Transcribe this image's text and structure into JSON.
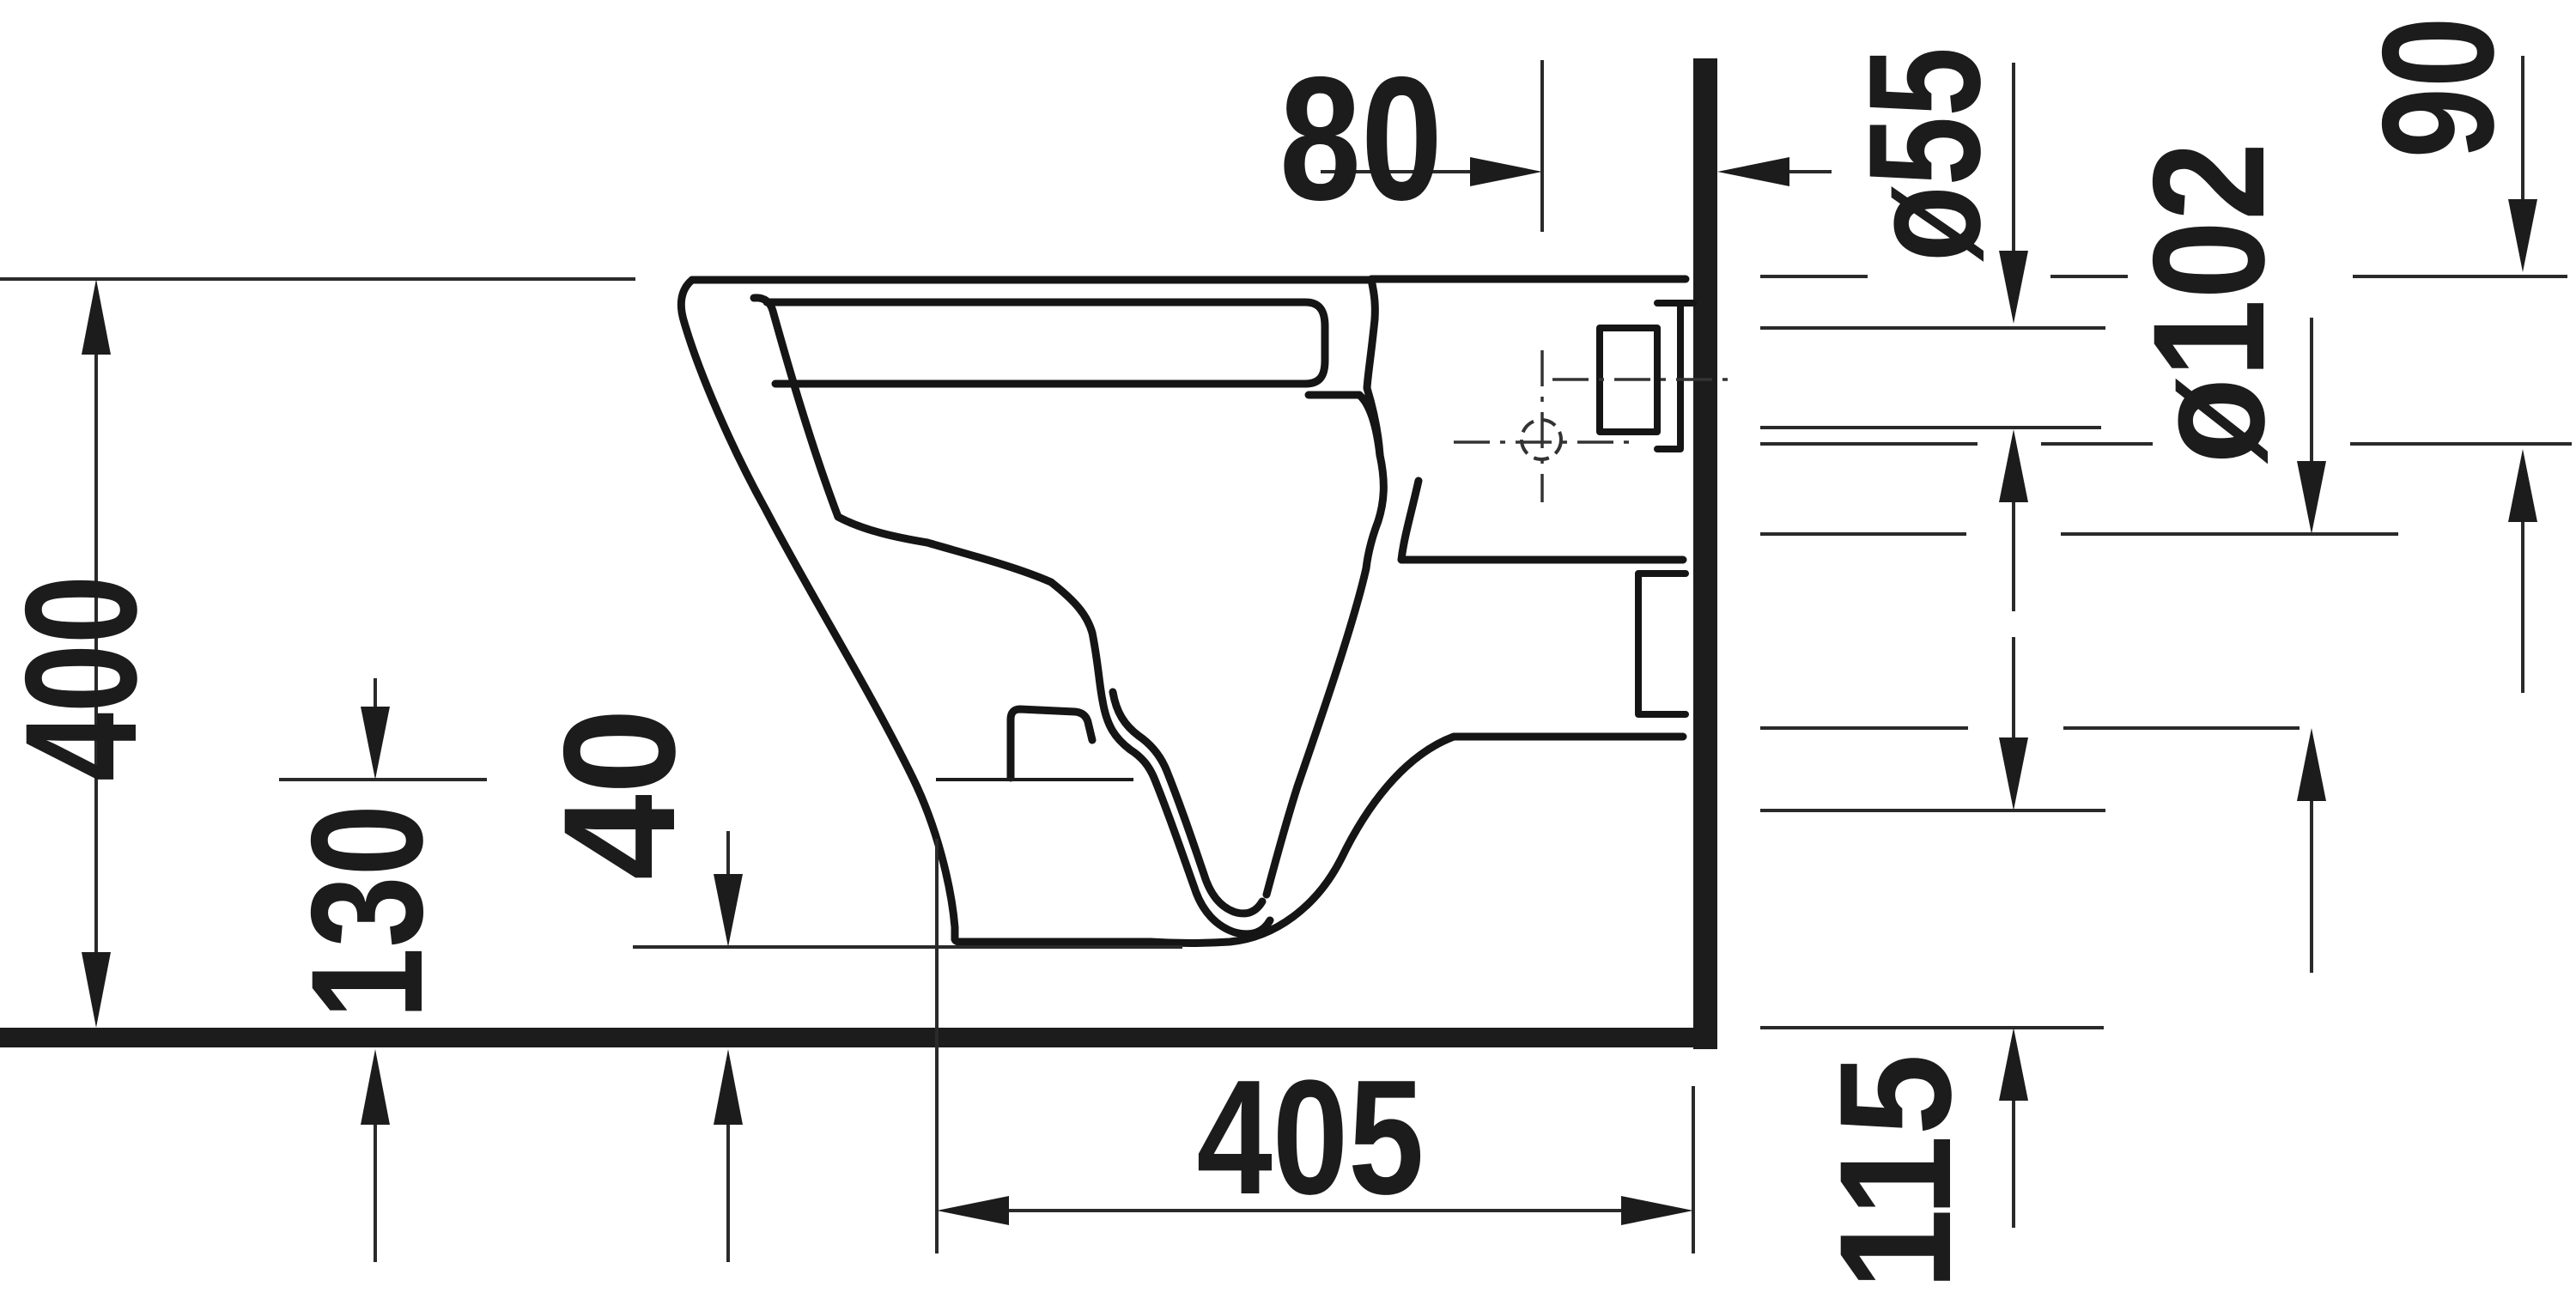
{
  "drawing": {
    "type": "technical installation drawing",
    "subject": "wall-hung toilet, side section view",
    "units": "mm",
    "ink_color": "#1c1c1c",
    "background_color": "#ffffff",
    "dimensions": {
      "rim_height": {
        "label": "400",
        "meaning": "height of rim/lid top above finished floor"
      },
      "underside_height": {
        "label": "130",
        "meaning": "height of bowl underside reference above floor"
      },
      "front_bottom_gap": {
        "label": "40",
        "meaning": "gap between ceramic front bottom edge and floor"
      },
      "top_wall_offset": {
        "label": "80",
        "meaning": "horizontal offset from fixing line to wall face"
      },
      "bottom_depth": {
        "label": "405",
        "meaning": "projection of bowl underside from wall face"
      },
      "supply_diameter": {
        "label": "ø55",
        "meaning": "water supply connection diameter"
      },
      "supply_drop": {
        "label": "90",
        "meaning": "vertical offset from rim level to supply-related line"
      },
      "outlet_diameter": {
        "label": "ø102",
        "meaning": "waste outlet connection diameter"
      },
      "outlet_height": {
        "label": "115",
        "meaning": "height of outlet underside line above floor level"
      }
    }
  }
}
